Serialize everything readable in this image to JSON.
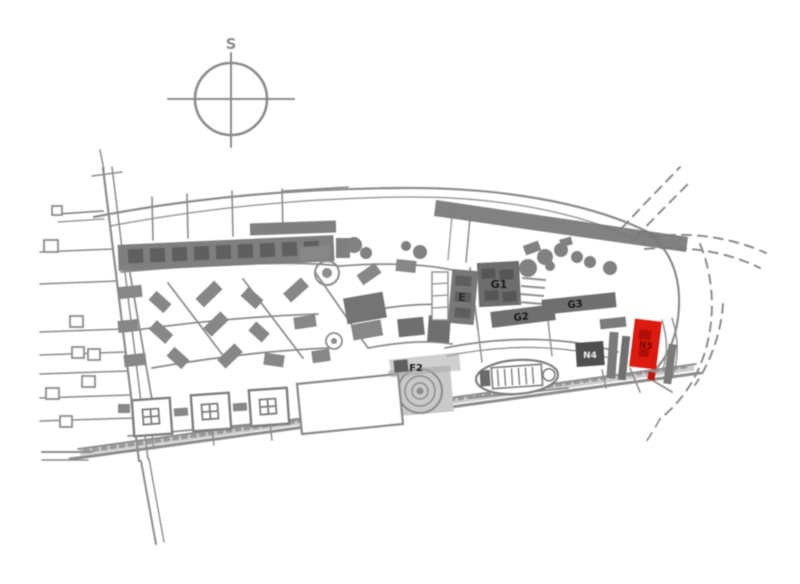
{
  "compass": {
    "label": "S"
  },
  "site_plan": {
    "type": "architectural-site-location-plan",
    "colors": {
      "line": "#8c8c8c",
      "building_fill": "#7f7f7f",
      "dark_building_fill": "#4f4f4f",
      "highlight_fill": "#dd1a10",
      "label_dark": "#1a1a1a",
      "label_light": "#f0f0f0",
      "highlight_label": "#6b0500"
    },
    "buildings": {
      "e": {
        "label": "E",
        "highlighted": false
      },
      "g1": {
        "label": "G1",
        "highlighted": false
      },
      "g2": {
        "label": "G2",
        "highlighted": false
      },
      "g3": {
        "label": "G3",
        "highlighted": false
      },
      "f2": {
        "label": "F2",
        "highlighted": false
      },
      "n4": {
        "label": "N4",
        "highlighted": false
      },
      "n5": {
        "label": "N5",
        "highlighted": true
      }
    }
  }
}
